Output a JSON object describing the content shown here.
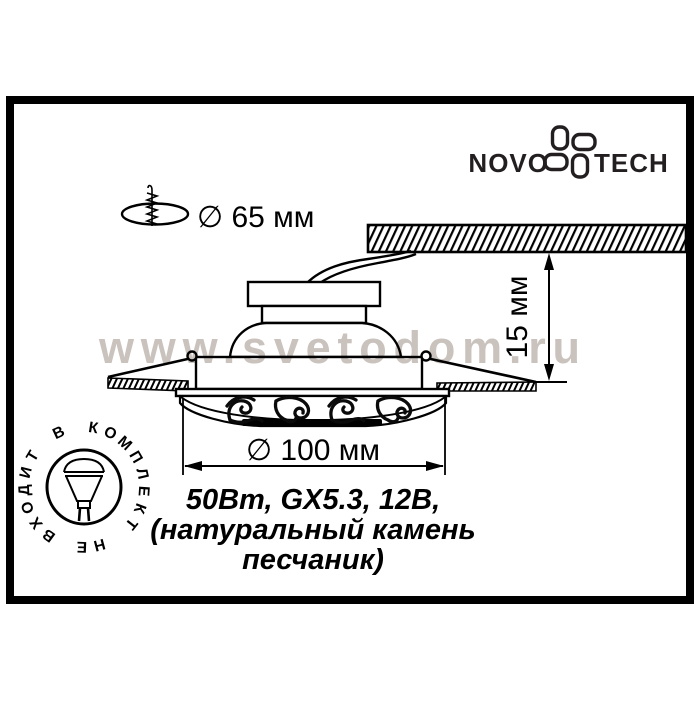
{
  "brand": {
    "name_left": "NOVO",
    "name_right": "TECH",
    "logo_icon": "novotech-flower-icon"
  },
  "watermark": {
    "text": "www.svetodom.ru",
    "color": "#c9c2bd"
  },
  "dimensions": {
    "cutout": {
      "label": "∅ 65 мм",
      "icon": "drill-hole-icon"
    },
    "height": {
      "label": "15 мм"
    },
    "diameter": {
      "label": "∅ 100 мм"
    }
  },
  "specs": {
    "line1": "50Вт, GX5.3, 12В,",
    "line2": "(натуральный камень",
    "line3": "песчаник)"
  },
  "stamp": {
    "text": "НЕ ВХОДИТ В КОМПЛЕКТ",
    "icon": "halogen-lamp-icon"
  },
  "colors": {
    "ink": "#000000",
    "watermark_gray": "#c9c2bd"
  }
}
